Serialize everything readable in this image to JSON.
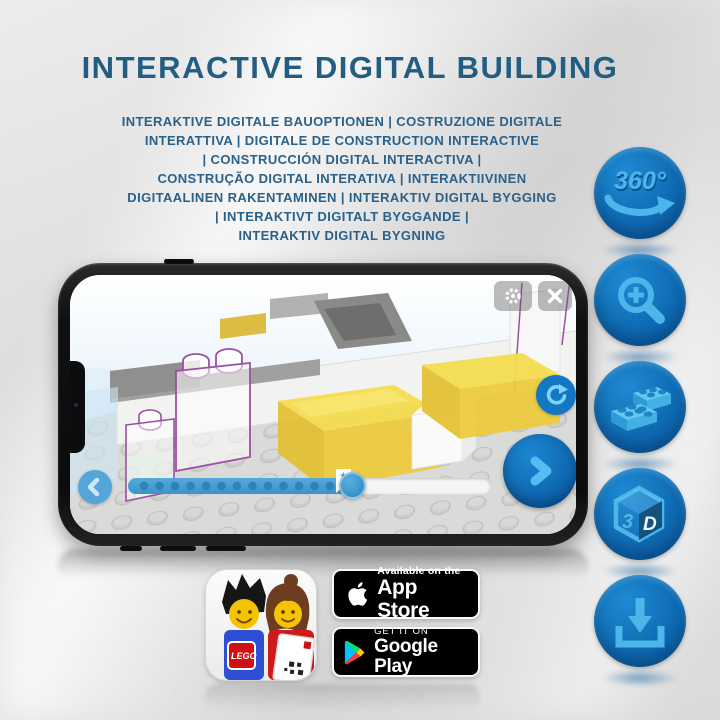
{
  "page": {
    "title": "INTERACTIVE DIGITAL BUILDING",
    "subtitle_lines": [
      "INTERAKTIVE DIGITALE BAUOPTIONEN | COSTRUZIONE DIGITALE",
      "INTERATTIVA | DIGITALE DE CONSTRUCTION INTERACTIVE",
      "| CONSTRUCCIÓN DIGITAL INTERACTIVA |",
      "CONSTRUÇÃO DIGITAL INTERATIVA | INTERAKTIIVINEN",
      "DIGITAALINEN RAKENTAMINEN | INTERAKTIV DIGITAL BYGGING",
      "| INTERAKTIVT DIGITALT BYGGANDE |",
      "INTERAKTIV DIGITAL BYGNING"
    ]
  },
  "features": [
    {
      "name": "rotate-360",
      "label": "360°"
    },
    {
      "name": "zoom-in"
    },
    {
      "name": "lego-bricks"
    },
    {
      "name": "3d-view",
      "face_left": "3",
      "face_right": "D"
    },
    {
      "name": "download"
    }
  ],
  "phone": {
    "screen_controls": [
      "settings",
      "close",
      "rotate-view",
      "previous-step",
      "next-step",
      "progress-slider"
    ],
    "progress_marker": "★"
  },
  "app_icon": {
    "logo_text": "LEGO"
  },
  "badges": {
    "app_store": {
      "tagline": "Available on the",
      "store": "App Store"
    },
    "google_play": {
      "tagline": "GET IT ON",
      "store": "Google Play"
    }
  },
  "colors": {
    "title_blue": "#235e82",
    "circle_blue": "#0f6cb4",
    "icon_light_blue": "#4cb6ea",
    "brick_yellow": "#f0d441",
    "outline_purple": "#9b50a2",
    "screen_sky": "#d3e9f6"
  }
}
